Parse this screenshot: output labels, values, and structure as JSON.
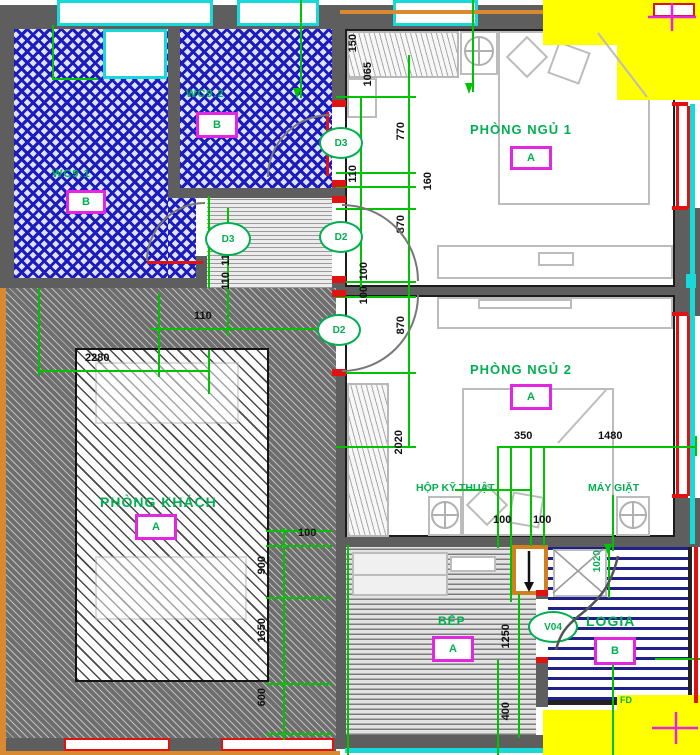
{
  "drawing": {
    "type": "apartment floor plan"
  },
  "colors": {
    "dimension_green": "#00c300",
    "label_green": "#00b050",
    "tag_magenta": "#e226e2",
    "wc_hatch_blue": "#1b1bbe",
    "logia_stripe_blue": "#20208c",
    "wall_gray": "#5e5e5e",
    "highlight_yellow": "#ffff00",
    "window_red": "#e01212",
    "frame_cyan": "#18d8d8",
    "balcony_orange": "#d98a30"
  },
  "rooms": {
    "wc1": {
      "label": "WC9.1",
      "type": "B"
    },
    "wc2": {
      "label": "WC9.2",
      "type": "B"
    },
    "bedroom1": {
      "label": "PHÒNG NGỦ 1",
      "type": "A"
    },
    "bedroom2": {
      "label": "PHÒNG NGỦ 2",
      "type": "A"
    },
    "living": {
      "label": "PHÒNG KHÁCH",
      "type": "A"
    },
    "kitchen": {
      "label": "BẾP",
      "type": "A"
    },
    "logia": {
      "label": "LOGIA",
      "type": "B"
    }
  },
  "annotations": {
    "tech_box": "HỘP KỸ THUẬT",
    "washer": "MÁY GIẶT",
    "floor_drain": "FD"
  },
  "door_tags": {
    "d3_corridor": "D3",
    "d3_wc2": "D3",
    "d2_bed1": "D2",
    "d2_bed2": "D2",
    "v04_logia": "V04"
  },
  "dims": {
    "list": [
      "150",
      "1065",
      "770",
      "110",
      "160",
      "870",
      "100",
      "100",
      "870",
      "2020",
      "110",
      "110",
      "110",
      "2280",
      "350",
      "1480",
      "100",
      "100",
      "100",
      "900",
      "1650",
      "600",
      "1250",
      "400",
      "1020"
    ]
  }
}
